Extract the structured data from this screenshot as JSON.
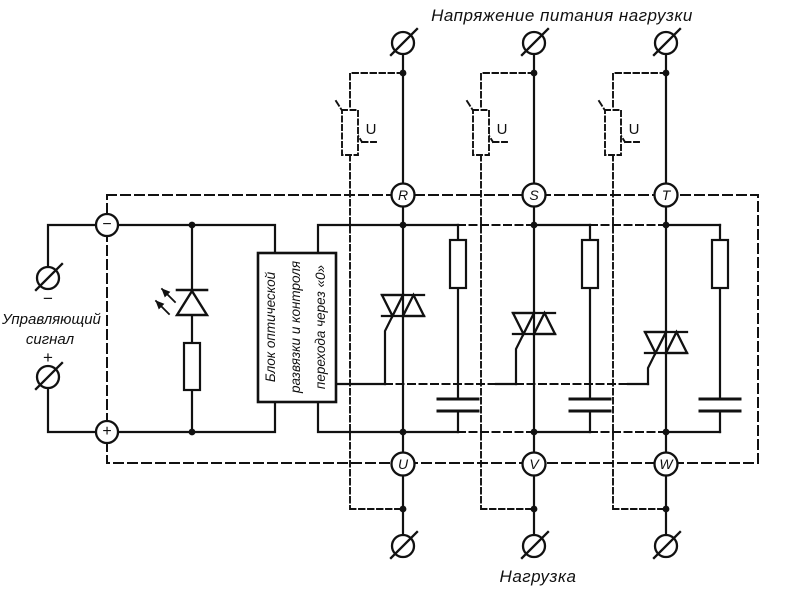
{
  "diagram": {
    "title_top": "Напряжение питания нагрузки",
    "label_bottom": "Нагрузка",
    "control": {
      "label_line1": "Управляющий",
      "label_line2": "сигнал",
      "minus_sign": "−",
      "plus_sign": "+"
    },
    "block": {
      "line1": "Блок оптической",
      "line2": "развязки и контроля",
      "line3": "перехода через «0»"
    },
    "terminals": {
      "top": [
        "R",
        "S",
        "T"
      ],
      "bottom": [
        "U",
        "V",
        "W"
      ],
      "control_minus": "−",
      "control_plus": "+"
    },
    "varistor_label": "U",
    "colors": {
      "ink": "#111111",
      "background": "#ffffff"
    }
  }
}
